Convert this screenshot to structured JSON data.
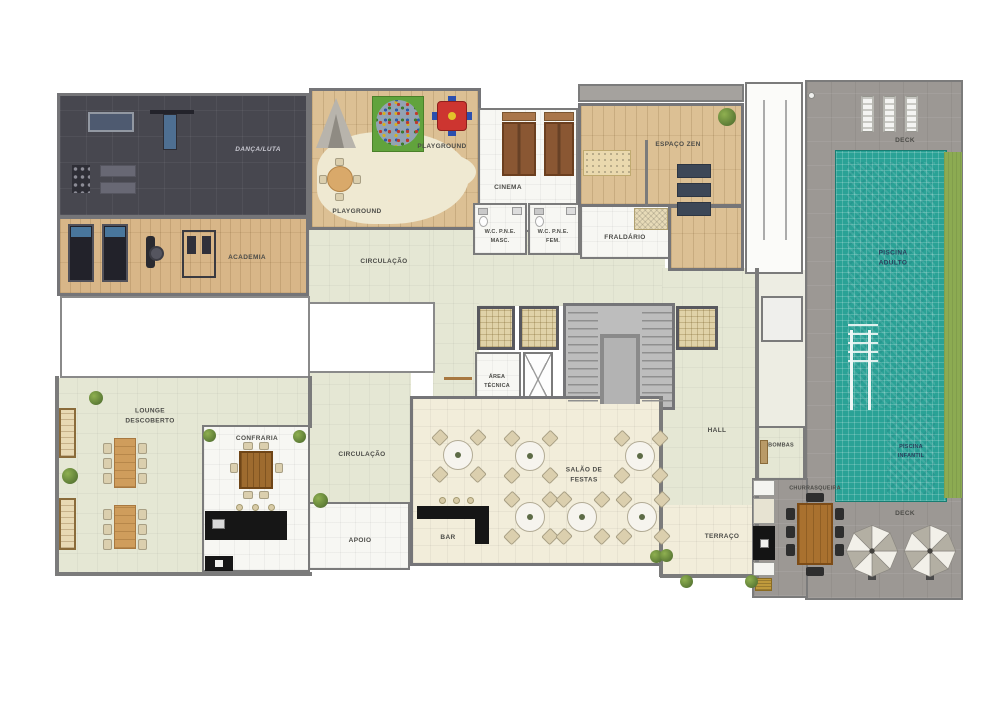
{
  "rooms": {
    "danca_luta": {
      "label": "DANÇA/LUTA"
    },
    "academia": {
      "label": "ACADEMIA"
    },
    "playground_upper": {
      "label": "PLAYGROUND"
    },
    "playground_lower": {
      "label": "PLAYGROUND"
    },
    "cinema": {
      "label": "CINEMA"
    },
    "wc_pne_masc": {
      "label": "W.C. P.N.E.",
      "label2": "MASC."
    },
    "wc_pne_fem": {
      "label": "W.C. P.N.E.",
      "label2": "FEM."
    },
    "fraldario": {
      "label": "FRALDÁRIO"
    },
    "espaco_zen": {
      "label": "ESPAÇO ZEN"
    },
    "circulacao_superior": {
      "label": "CIRCULAÇÃO"
    },
    "circulacao_inferior": {
      "label": "CIRCULAÇÃO"
    },
    "area_tecnica": {
      "label": "ÁREA",
      "label2": "TÉCNICA"
    },
    "lounge_descoberto": {
      "label": "LOUNGE",
      "label2": "DESCOBERTO"
    },
    "confraria": {
      "label": "CONFRARIA"
    },
    "apoio": {
      "label": "APOIO"
    },
    "bar": {
      "label": "BAR"
    },
    "salao_de_festas": {
      "label": "SALÃO DE",
      "label2": "FESTAS"
    },
    "hall": {
      "label": "HALL"
    },
    "bombas": {
      "label": "BOMBAS"
    },
    "terraco": {
      "label": "TERRAÇO"
    },
    "churrasqueira": {
      "label": "CHURRASQUEIRA"
    },
    "deck_superior": {
      "label": "DECK"
    },
    "deck_inferior": {
      "label": "DECK"
    },
    "piscina_adulto": {
      "label": "PISCINA",
      "label2": "ADULTO"
    },
    "piscina_infantil": {
      "label": "PISCINA",
      "label2": "INFANTIL"
    }
  },
  "palette": {
    "floor_circulation": "#e5e7d4",
    "floor_party_room": "#f2edda",
    "floor_white_rooms": "#f7f7f3",
    "floor_wood": "#dcc094",
    "floor_dance_room": "#47474f",
    "pool_deck": "#9c9894",
    "pool_tile": "#2aa296",
    "pool_water": "#45a9c2",
    "grass": "#8cab52",
    "walls": "#7b7b7b",
    "counters": "#161616",
    "furniture_wood": "#a9712f"
  }
}
